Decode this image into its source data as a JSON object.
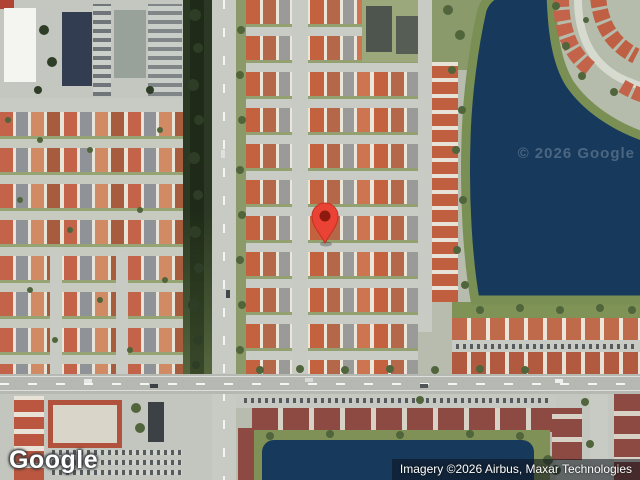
{
  "map_view": {
    "kind": "satellite",
    "logo_text": "Google",
    "watermark_text": "© 2026 Google",
    "attribution_text": "Imagery ©2026 Airbus, Maxar Technologies",
    "marker": {
      "color": "#ea4335",
      "inner_color": "#8e1a0f"
    },
    "colors": {
      "water": "#17395c",
      "shore_vegetation": "#7a8f54",
      "roof_orange": "#c2634a",
      "roof_maroon": "#8c4a42",
      "road": "#c7cbc3",
      "land": "#b7bcae"
    }
  }
}
